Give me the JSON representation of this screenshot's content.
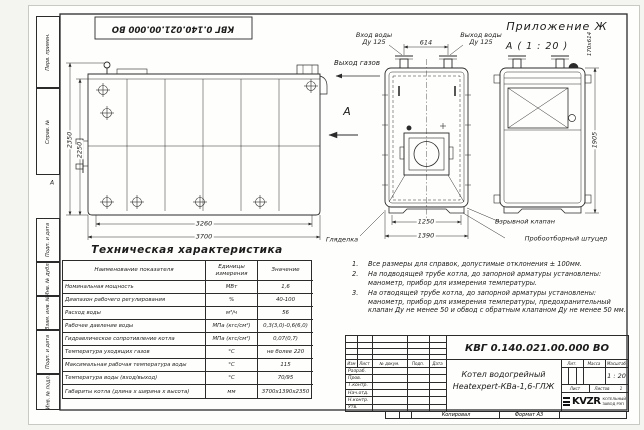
{
  "colors": {
    "line": "#2b2b2b",
    "paper": "#fefefc"
  },
  "frame": {
    "stamp_top": "КВГ 0.140.021.00.000 ВО",
    "appendix": "Приложение Ж",
    "detail_view_label": "А ( 1 : 20 )",
    "fold_mark": "А",
    "margin_labels": [
      "Перв. примен.",
      "Справ. №",
      "Подп. и дата",
      "Инв. № дубл.",
      "Взам. инв. №",
      "Подп. и дата",
      "Инв. № подл."
    ]
  },
  "callouts": {
    "gas_outlet": "Выход газов",
    "water_inlet_line1": "Вход воды",
    "water_inlet_line2": "Ду 125",
    "water_outlet_line1": "Выход воды",
    "water_outlet_line2": "Ду 125",
    "sight_glass": "Гляделка",
    "explosion_valve": "Взрывной клапан",
    "sampling_fitting": "Пробоотборный штуцер",
    "section_arrow": "А"
  },
  "dimensions": {
    "overall_height": "2350",
    "body_height": "2250",
    "body_length": "3260",
    "overall_length": "3700",
    "nozzle_spacing": "614",
    "body_width": "1250",
    "overall_width": "1390",
    "rear_height": "1905",
    "opening_size": "170х614"
  },
  "spec_table": {
    "title": "Техническая характеристика",
    "headers": [
      "Наименование показателя",
      "Единицы измерения",
      "Значение"
    ],
    "rows": [
      [
        "Номинальная мощность",
        "МВт",
        "1,6"
      ],
      [
        "Диапазон рабочего регулирования",
        "%",
        "40-100"
      ],
      [
        "Расход воды",
        "м³/ч",
        "56"
      ],
      [
        "Рабочее давление воды",
        "МПа (кгс/см²)",
        "0,3(3,0)-0,6(6,0)"
      ],
      [
        "Гидравлическое сопротивление котла",
        "МПа (кгс/см²)",
        "0,07(0,7)"
      ],
      [
        "Температура уходящих газов",
        "°С",
        "не более 220"
      ],
      [
        "Максимальная рабочая температура воды",
        "°С",
        "115"
      ],
      [
        "Температура воды (вход/выход)",
        "°С",
        "70/95"
      ],
      [
        "Габариты котла (длина х ширина х высота)",
        "мм",
        "3700х1390х2350"
      ]
    ]
  },
  "notes": [
    "Все размеры для справок, допустимые отклонения ± 100мм.",
    "На подводящей трубе котла, до запорной арматуры установлены: манометр, прибор для измерения температуры.",
    "На отводящей трубе котла, до запорной арматуры установлены: манометр, прибор для измерения температуры, предохранительный клапан Ду не менее 50 и обвод с обратным клапаном Ду не менее 50 мм."
  ],
  "title_block": {
    "doc_number": "КВГ 0.140.021.00.000 ВО",
    "product_line1": "Котел водогрейный",
    "product_line2": "Heatexpert-КВа-1,6-ГЛЖ",
    "header_cols": [
      "Изм",
      "Лист",
      "№ докум.",
      "Подп.",
      "Дата"
    ],
    "row_labels": [
      "Разраб.",
      "Пров.",
      "Т.контр.",
      "Нач.отд.",
      "Н.контр.",
      "Утв."
    ],
    "lit_label": "Лит.",
    "mass_label": "Масса",
    "scale_label": "Масштаб",
    "scale_value": "1 : 20",
    "sheet_label": "Лист",
    "sheets_label": "Листов",
    "sheets_value": "1",
    "logo_text": "KVZR",
    "logo_sub1": "КОТЕЛЬНЫЙ",
    "logo_sub2": "ЗАВОД РЭП",
    "copied_label": "Копировал",
    "format_label": "Формат А3"
  }
}
